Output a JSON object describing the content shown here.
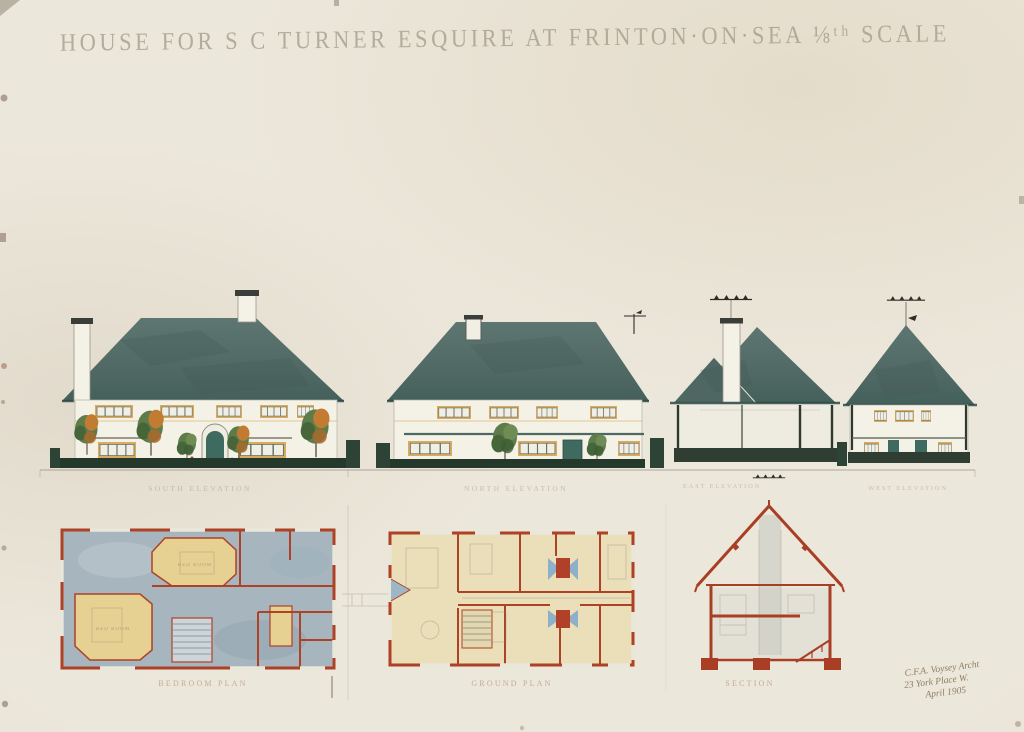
{
  "artwork": {
    "title": "HOUSE FOR S C TURNER ESQUIRE AT FRINTON·ON·SEA ⅛ᵗʰ SCALE"
  },
  "elevations": {
    "captions": [
      "SOUTH ELEVATION",
      "NORTH ELEVATION",
      "EAST ELEVATION",
      "WEST ELEVATION"
    ]
  },
  "plans": {
    "captions": [
      "BEDROOM PLAN",
      "GROUND PLAN",
      "SECTION"
    ],
    "room_labels": [
      "BED ROOM",
      "BED ROOM"
    ]
  },
  "signature": {
    "lines": [
      "C.F.A. Voysey Archt",
      "23 York Place W.",
      "April 1905"
    ]
  },
  "colors": {
    "paper": "#eae5d9",
    "roof": "#56706b",
    "roof_dark": "#3f5752",
    "wall": "#f4f1e7",
    "base_green": "#24382c",
    "foliage": "#5e7c4a",
    "foliage_accent": "#c27c31",
    "window_ochre": "#d9ab5e",
    "door_teal": "#3f6a60",
    "plan_red": "#ad4226",
    "plan_yellow": "#e6d092",
    "plan_blue": "#a7b5bf",
    "plan_cream": "#ebdfba",
    "pencil": "#8e8a7e",
    "title_ink": "#a79d8c",
    "signature_ink": "#7d6a4f"
  }
}
